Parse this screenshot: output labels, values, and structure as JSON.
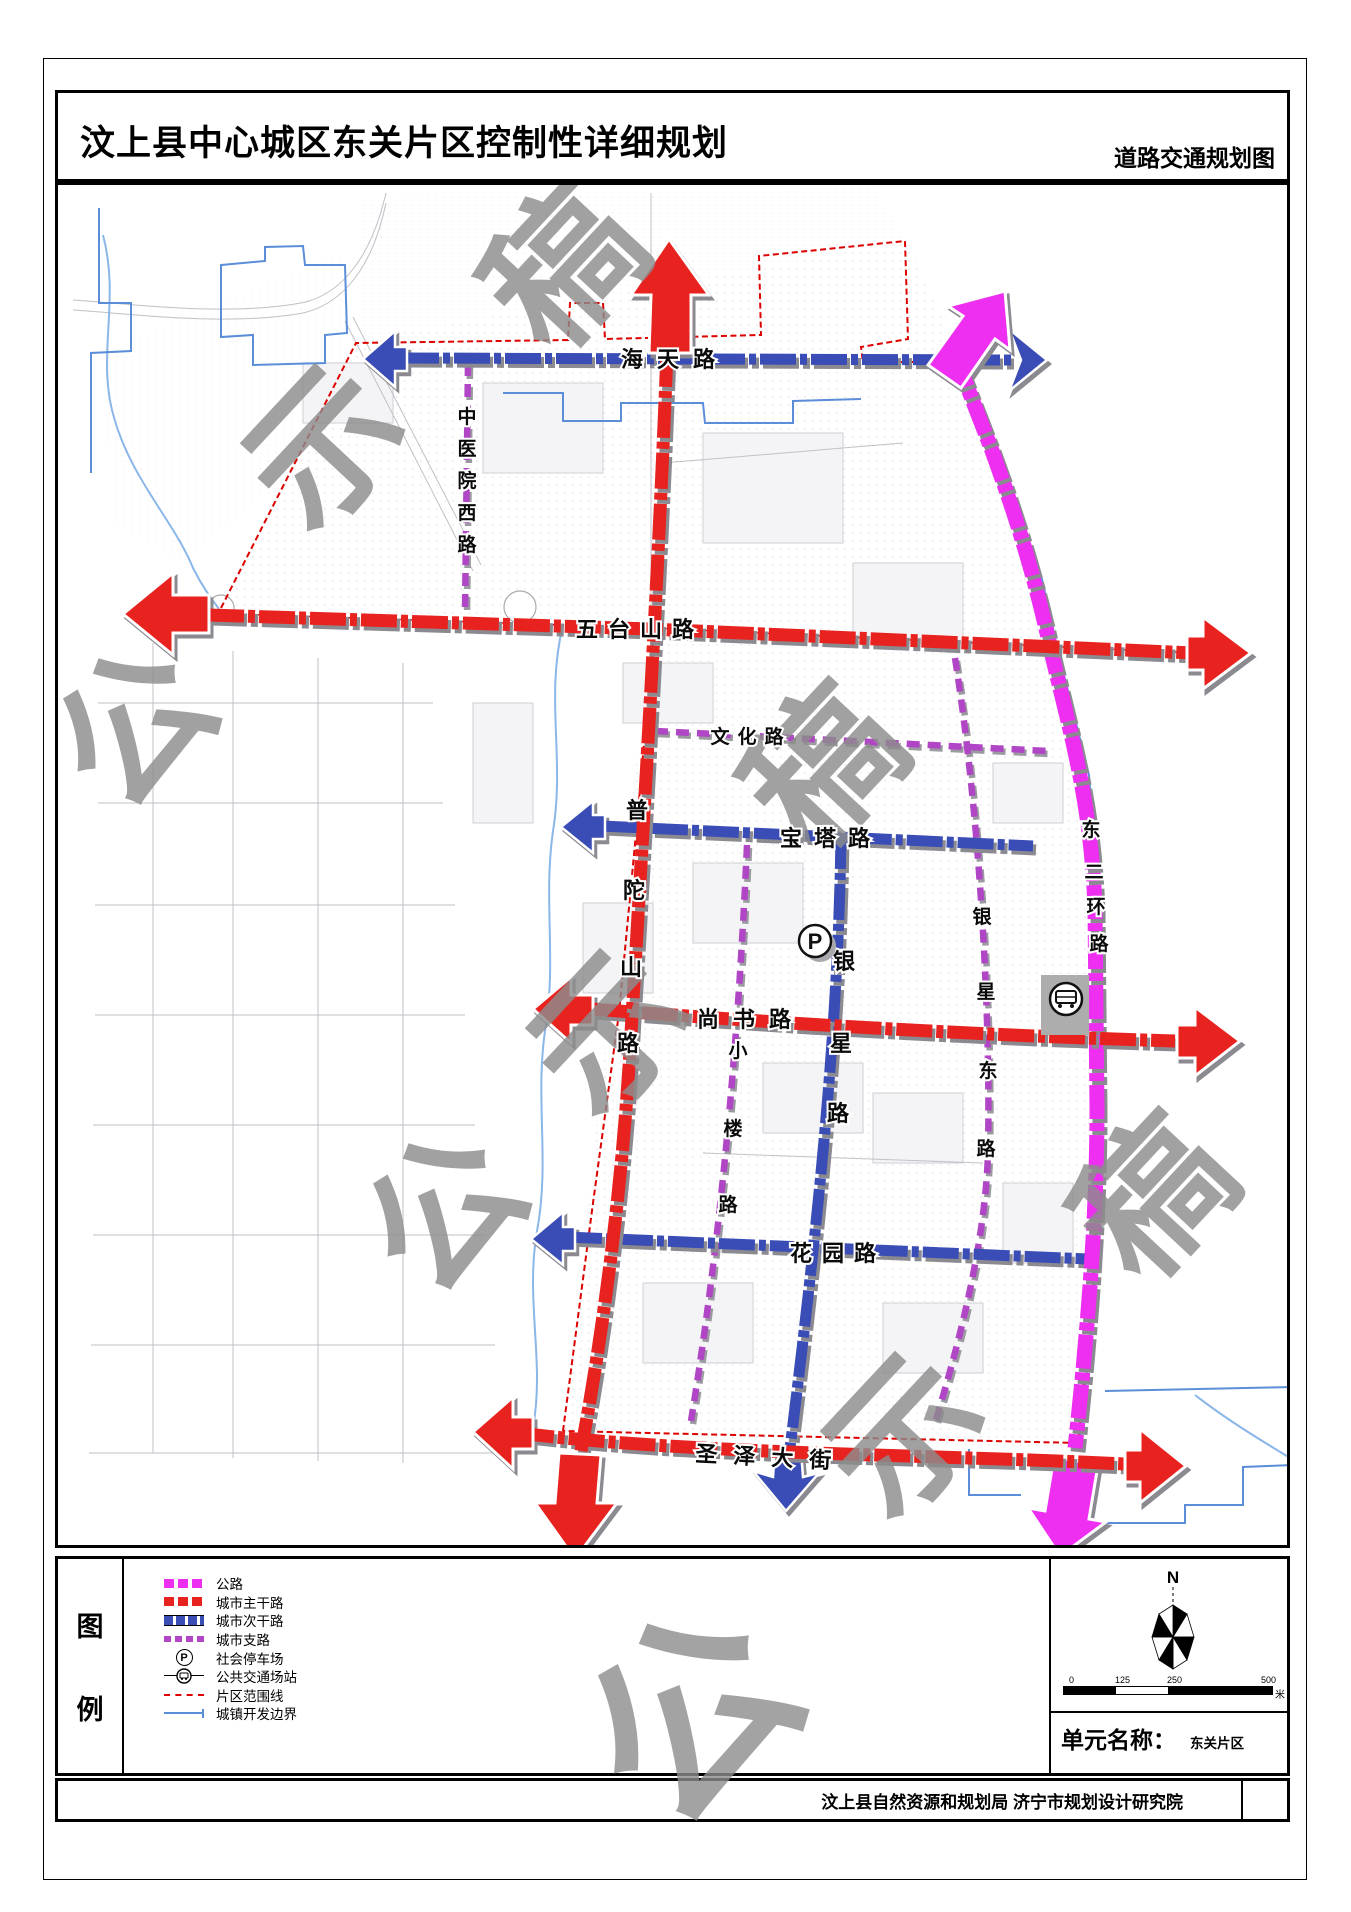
{
  "header": {
    "title": "汶上县中心城区东关片区控制性详细规划",
    "subtitle": "道路交通规划图"
  },
  "map": {
    "watermark": "公示稿",
    "road_names": {
      "haitian": "海天路",
      "zhongyiyuan_xi": "中医院西路",
      "wutaishan": "五台山路",
      "wenhua": "文化路",
      "baota": "宝塔路",
      "putuoshan": "普陀山路",
      "yinxing": "银星路",
      "yinxing_dong": "银星东路",
      "xiaolou": "小楼路",
      "shangshu": "尚书路",
      "huayuan": "花园路",
      "dong_erhuan": "东二环路",
      "shengze": "圣泽大街"
    },
    "parking_icon_label": "P"
  },
  "legend": {
    "title": "图例",
    "items": [
      {
        "id": "highway",
        "label": "公路"
      },
      {
        "id": "arterial",
        "label": "城市主干路"
      },
      {
        "id": "secondary",
        "label": "城市次干路"
      },
      {
        "id": "branch",
        "label": "城市支路"
      },
      {
        "id": "parking",
        "label": "社会停车场"
      },
      {
        "id": "transit",
        "label": "公共交通场站"
      },
      {
        "id": "district_boundary",
        "label": "片区范围线"
      },
      {
        "id": "dev_boundary",
        "label": "城镇开发边界"
      }
    ]
  },
  "info": {
    "north_label": "N",
    "scale_ticks": [
      "0",
      "125",
      "250",
      "500"
    ],
    "scale_unit": "米",
    "unit_name_label": "单元名称：",
    "unit_name_value": "东关片区"
  },
  "footer": {
    "credit": "汶上县自然资源和规划局 济宁市规划设计研究院"
  },
  "colors": {
    "highway": "#EE2EF0",
    "arterial": "#E8231F",
    "secondary": "#3A4CB5",
    "branch": "#B045C5",
    "district_boundary": "#DD0000",
    "dev_boundary": "#5B8DD9",
    "water": "#8AB6E8",
    "watermark": "#8D8D8D"
  }
}
